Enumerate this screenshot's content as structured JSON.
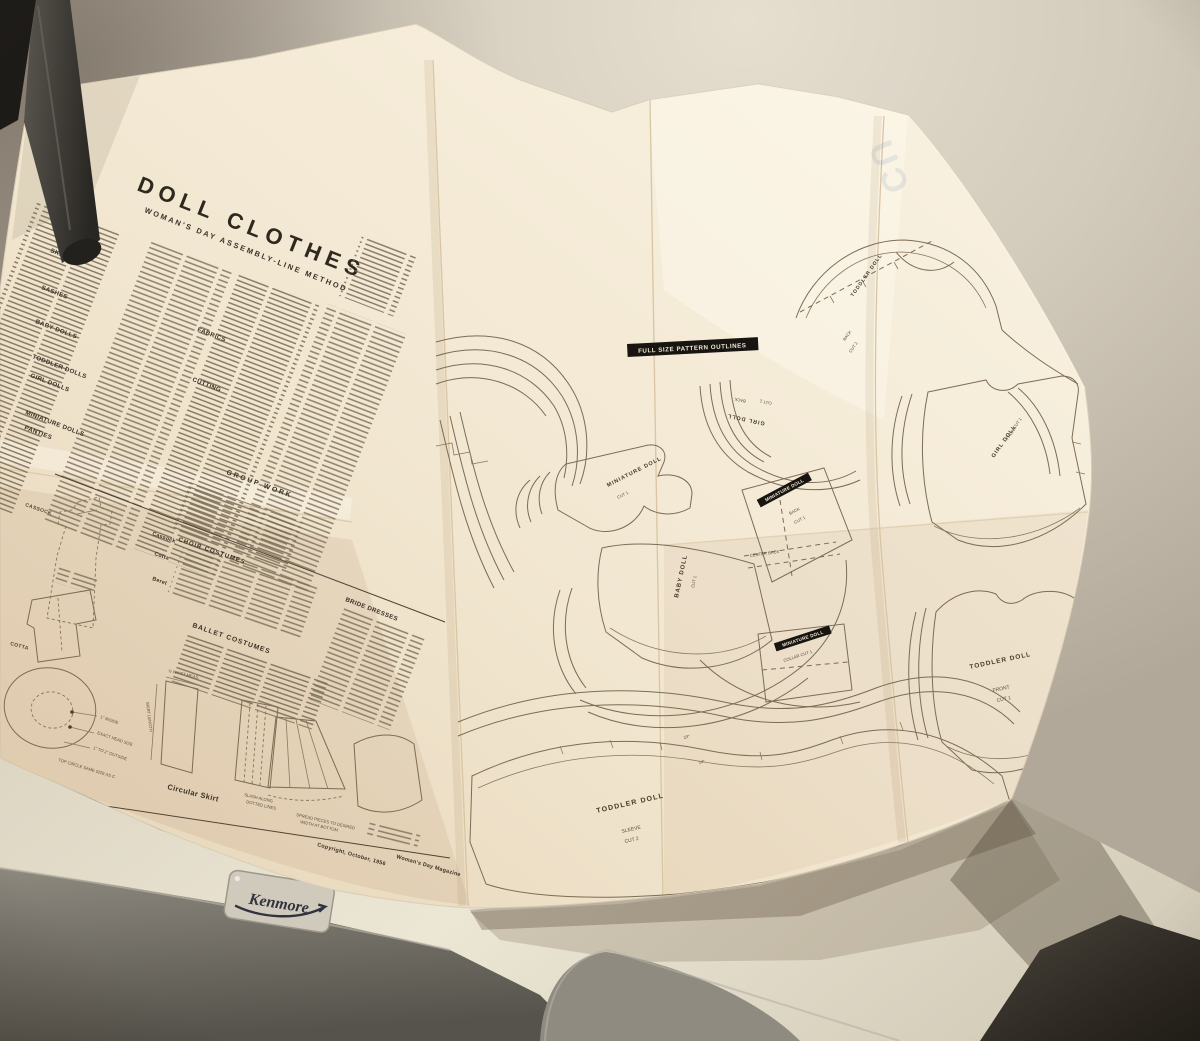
{
  "colors": {
    "wall": "#c7beb0",
    "wall_bright": "#e6dfd0",
    "paper": "#f2e8d3",
    "paper_shadow": "#e2d2b6",
    "ink": "#3a3126",
    "banner_bg": "#181410",
    "banner_text": "#f1e9d7",
    "appliance_top": "#e8e2d1",
    "appliance_front": "#7e7a71",
    "shadow_dark": "#242019",
    "kenmore_text": "#32323e"
  },
  "sheet": {
    "title": "DOLL CLOTHES",
    "subtitle": "WOMAN'S DAY ASSEMBLY-LINE METHOD",
    "headings": {
      "skirts": "SKIRTS",
      "sashes": "SASHES",
      "baby_dolls": "BABY DOLLS",
      "toddler_dolls": "TODDLER DOLLS",
      "girl_dolls": "GIRL DOLLS",
      "miniature_dolls": "MINIATURE DOLLS",
      "panties": "PANTIES",
      "fabrics": "FABRICS",
      "cutting": "CUTTING",
      "group_work": "GROUP WORK",
      "cassock": "Cassock",
      "choir_costumes": "CHOIR COSTUMES",
      "cotta": "Cotta",
      "beret": "Beret",
      "bride_dresses": "BRIDE DRESSES",
      "ballet_costumes": "BALLET COSTUMES",
      "circular_skirt": "Circular Skirt"
    },
    "banner": "FULL SIZE PATTERN OUTLINES",
    "pieces": {
      "girl_back": {
        "name": "GIRL DOLL",
        "part": "BACK",
        "cut": "CUT 1"
      },
      "girl_front": {
        "name": "GIRL DOLL",
        "part": "FRONT",
        "cut": "CUT 1"
      },
      "toddler_back": {
        "name": "TODDLER DOLL",
        "part": "BACK",
        "cut": "CUT 2"
      },
      "toddler_front": {
        "name": "TODDLER DOLL",
        "part": "FRONT",
        "cut": "CUT 1"
      },
      "toddler_sleeve": {
        "name": "TODDLER DOLL",
        "part": "SLEEVE",
        "cut": "CUT 2"
      },
      "baby": {
        "name": "BABY DOLL",
        "cut": "CUT 1"
      },
      "miniature": {
        "name": "MINIATURE DOLL",
        "cut": "CUT 1"
      },
      "miniature_back": {
        "name": "MINIATURE DOLL",
        "part": "BACK",
        "cut": "CUT 1"
      },
      "miniature_collar": {
        "name": "MINIATURE DOLL",
        "part": "COLLAR  CUT 1"
      },
      "center_back": "CENTER BACK",
      "dim_23": "23\"",
      "dim_14": "14\""
    },
    "notes": {
      "cassock": "CASSOCK",
      "cotta": "COTTA",
      "inside": "1\" INSIDE",
      "head": "EXACT HEAD SIZE",
      "outside": "1\" TO 2\" OUTSIDE",
      "top_circle": "TOP CIRCLE SAME SIZE AS C",
      "waist": "½ WAIST MEAS.",
      "length": "SKIRT LENGTH",
      "slash_1": "SLASH ALONG",
      "slash_2": "DOTTED LINES",
      "spread_1": "SPREAD PIECES TO DESIRED",
      "spread_2": "WIDTH AT BOTTOM"
    },
    "showthrough": "CU",
    "footer": {
      "copyright": "Copyright, October, 1956",
      "magazine": "Woman's Day Magazine"
    }
  },
  "appliance": {
    "brand": "Kenmore"
  }
}
